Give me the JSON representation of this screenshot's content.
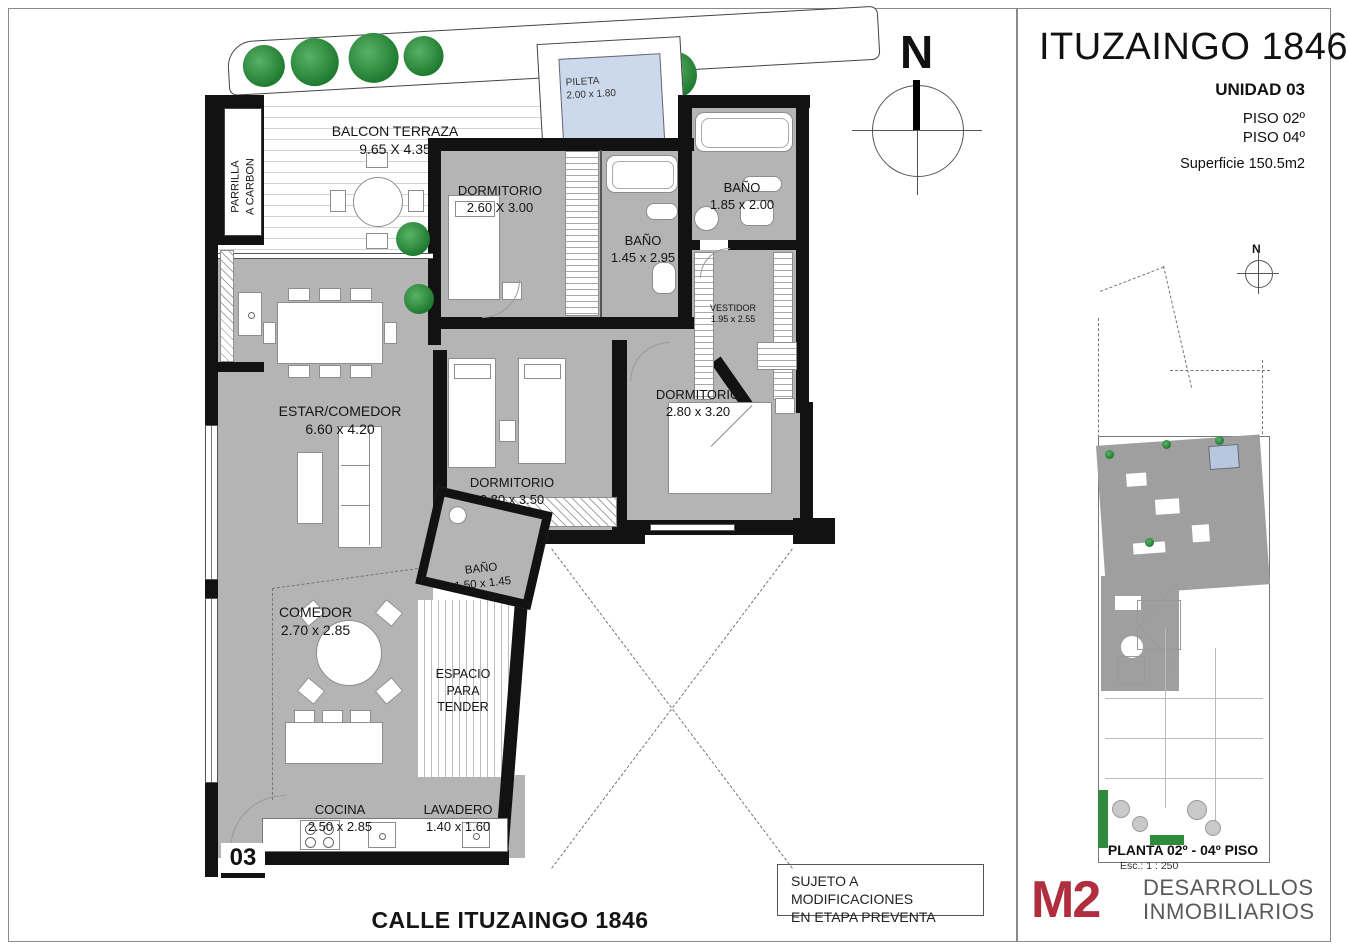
{
  "colors": {
    "accent_red": "#b02e3e",
    "room_fill": "#b4b4b4",
    "wall_black": "#121212",
    "pool_blue": "#ccd8eb",
    "plant_green": "#2e8b3e"
  },
  "plan": {
    "compass_n": "N",
    "street": "CALLE ITUZAINGO 1846",
    "unit_number": "03",
    "rooms": [
      {
        "label": "BALCON TERRAZA",
        "dims": "9.65 X 4.35"
      },
      {
        "label": "PILETA",
        "dims": "2.00 x 1.80"
      },
      {
        "label": "DORMITORIO",
        "dims": "2.60 X 3.00"
      },
      {
        "label": "BAÑO",
        "dims": "1.45 x 2.95"
      },
      {
        "label": "BAÑO",
        "dims": "1.85 x 2.00"
      },
      {
        "label": "VESTIDOR",
        "dims": "1.95 x 2.55"
      },
      {
        "label": "DORMITORIO",
        "dims": "2.80 x 3.20"
      },
      {
        "label": "ESTAR/COMEDOR",
        "dims": "6.60 x 4.20"
      },
      {
        "label": "DORMITORIO",
        "dims": "2.80 x 3.50"
      },
      {
        "label": "BAÑO",
        "dims": "1.50 x 1.45"
      },
      {
        "label": "COMEDOR",
        "dims": "2.70 x 2.85"
      },
      {
        "label": "ESPACIO\nPARA\nTENDER",
        "dims": ""
      },
      {
        "label": "COCINA",
        "dims": "2.50 x 2.85"
      },
      {
        "label": "LAVADERO",
        "dims": "1.40 x 1.60"
      },
      {
        "label": "PARRILLA\nA CARBON",
        "dims": ""
      }
    ]
  },
  "panel": {
    "title": "ITUZAINGO 1846",
    "unit": "UNIDAD 03",
    "floor1": "PISO 02º",
    "floor2": "PISO 04º",
    "surface": "Superficie 150.5m2",
    "mini": {
      "compass_n": "N",
      "caption": "PLANTA 02º - 04º PISO",
      "scale": "Esc.: 1 : 250"
    },
    "logo": {
      "mark": "M2",
      "line1": "DESARROLLOS",
      "line2": "INMOBILIARIOS"
    }
  },
  "disclaimer": {
    "line1": "SUJETO A MODIFICACIONES",
    "line2": "EN ETAPA PREVENTA"
  }
}
